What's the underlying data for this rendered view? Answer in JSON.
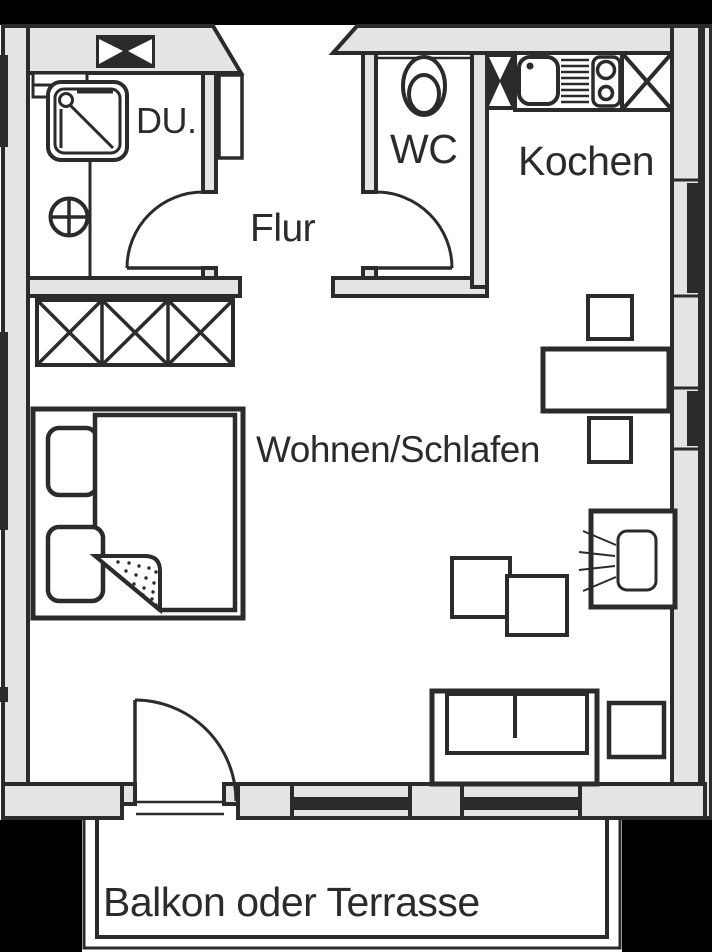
{
  "title": "Apartment floor plan",
  "labels": {
    "du": "DU.",
    "flur": "Flur",
    "wc": "WC",
    "kochen": "Kochen",
    "wohnen": "Wohnen/Schlafen",
    "balkon": "Balkon oder Terrasse"
  },
  "colors": {
    "bg": "#000000",
    "paper": "#ffffff",
    "wall": "#e4e4e6",
    "line": "#2b2b2b"
  }
}
